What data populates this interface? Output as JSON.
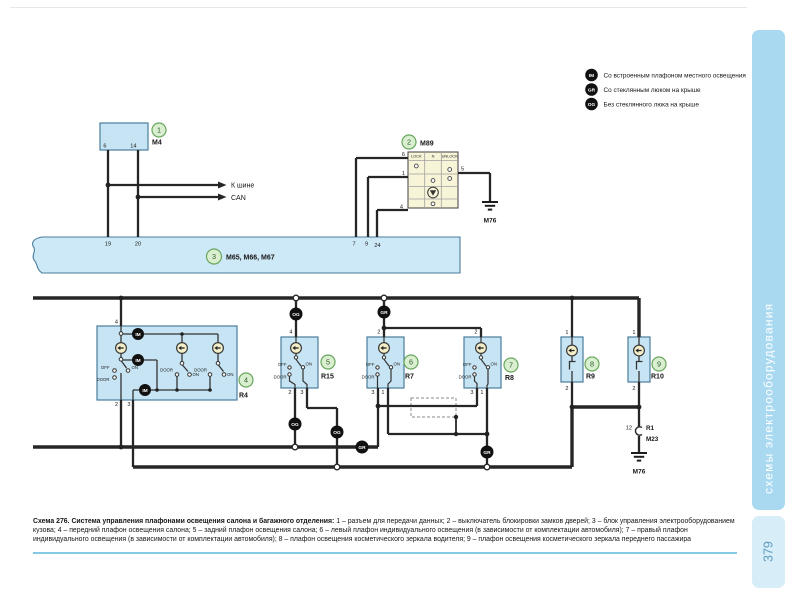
{
  "page": {
    "sidebar_label": "схемы электрооборудования",
    "page_number": "379"
  },
  "legend": {
    "item1": {
      "badge": "IM",
      "label": "Со встроенным плафоном местного освещения"
    },
    "item2": {
      "badge": "GR",
      "label": "Со стеклянным люком на крыше"
    },
    "item3": {
      "badge": "OG",
      "label": "Без стеклянного люка на крыше"
    }
  },
  "labels": {
    "bus1": "К шине",
    "bus2": "CAN",
    "off": "OFF",
    "on": "ON",
    "door": "DOOR",
    "im": "IM",
    "gr": "GR",
    "og": "OG",
    "ground": "М76"
  },
  "m4": {
    "num": "1",
    "id": "M4",
    "pin6": "6",
    "pin14": "14"
  },
  "m89": {
    "num": "2",
    "id": "M89",
    "lock": "LOCK",
    "n": "N",
    "unlock": "UNLOCK",
    "pin6": "6",
    "pin1": "1",
    "pin5": "5",
    "pin4": "4"
  },
  "band": {
    "num": "3",
    "id": "М65, М66, М67",
    "pin19": "19",
    "pin20": "20",
    "pin7": "7",
    "pin9": "9",
    "pin24": "24"
  },
  "r4": {
    "num": "4",
    "id": "R4",
    "pin_top": "4",
    "pin_b1": "2",
    "pin_b2": "3"
  },
  "r15": {
    "num": "5",
    "id": "R15",
    "pin_top": "4",
    "pin_b1": "2",
    "pin_b2": "3"
  },
  "r7": {
    "num": "6",
    "id": "R7",
    "pin_top": "2",
    "pin_b1": "3",
    "pin_b2": "1"
  },
  "r8": {
    "num": "7",
    "id": "R8",
    "pin_top": "2",
    "pin_b1": "3",
    "pin_b2": "1"
  },
  "r9": {
    "num": "8",
    "id": "R9",
    "pin_top": "1",
    "pin_bottom": "2"
  },
  "r10": {
    "num": "9",
    "id": "R10",
    "pin_top": "1",
    "pin_bottom": "2"
  },
  "r1": {
    "pin": "12",
    "id": "R1",
    "module": "M23"
  },
  "caption": {
    "title": "Схема 276. Система управления плафонами освещения салона и багажного отделения:",
    "body": "1 – разъем для передачи данных; 2 – выключатель блокировки замков дверей; 3 – блок управления электрооборудованием кузова; 4 – передний плафон освещения салона; 5 – задний плафон освещения салона; 6 – левый плафон индивидуального освещения (в зависимости от комплектации автомобиля); 7 – правый плафон индивидуального освещения (в зависимости от комплектации автомобиля); 8 – плафон освещения косметического зеркала водителя; 9 – плафон освещения косметического зеркала переднего пассажира"
  },
  "colors": {
    "block_fill": "#c6e4f3",
    "band_fill": "#cde8f6",
    "m89_fill": "#f8f4d8",
    "tab_fill": "#a9d9f0",
    "page_tab_fill": "#d7edf8",
    "accent_rule": "#84c9e6",
    "callout_fill": "#daeed0",
    "callout_stroke": "#68a75d",
    "wire": "#262626"
  }
}
